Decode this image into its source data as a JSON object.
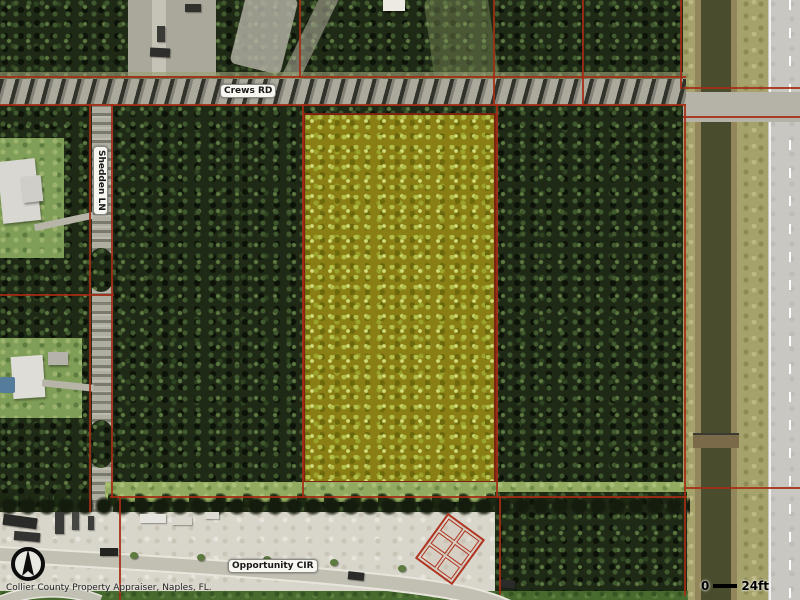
{
  "map": {
    "attribution": "Collier County Property Appraiser, Naples, FL.",
    "roads": [
      {
        "label": "Crews RD",
        "orientation": "horizontal"
      },
      {
        "label": "Shedden LN",
        "orientation": "vertical"
      },
      {
        "label": "Opportunity CIR",
        "orientation": "horizontal"
      }
    ],
    "scale_bar": {
      "start_label": "0",
      "end_label": "24ft"
    },
    "icons": [
      {
        "name": "north-arrow-icon"
      }
    ],
    "colors": {
      "parcel_line": "#a52c14",
      "highlight_parcel_fill": "#8a7f15",
      "highlight_parcel_border": "#7c2412",
      "forest": "#1f2a16",
      "sand": "#d8d5ca",
      "canal_water": "#4a4d2d"
    }
  }
}
